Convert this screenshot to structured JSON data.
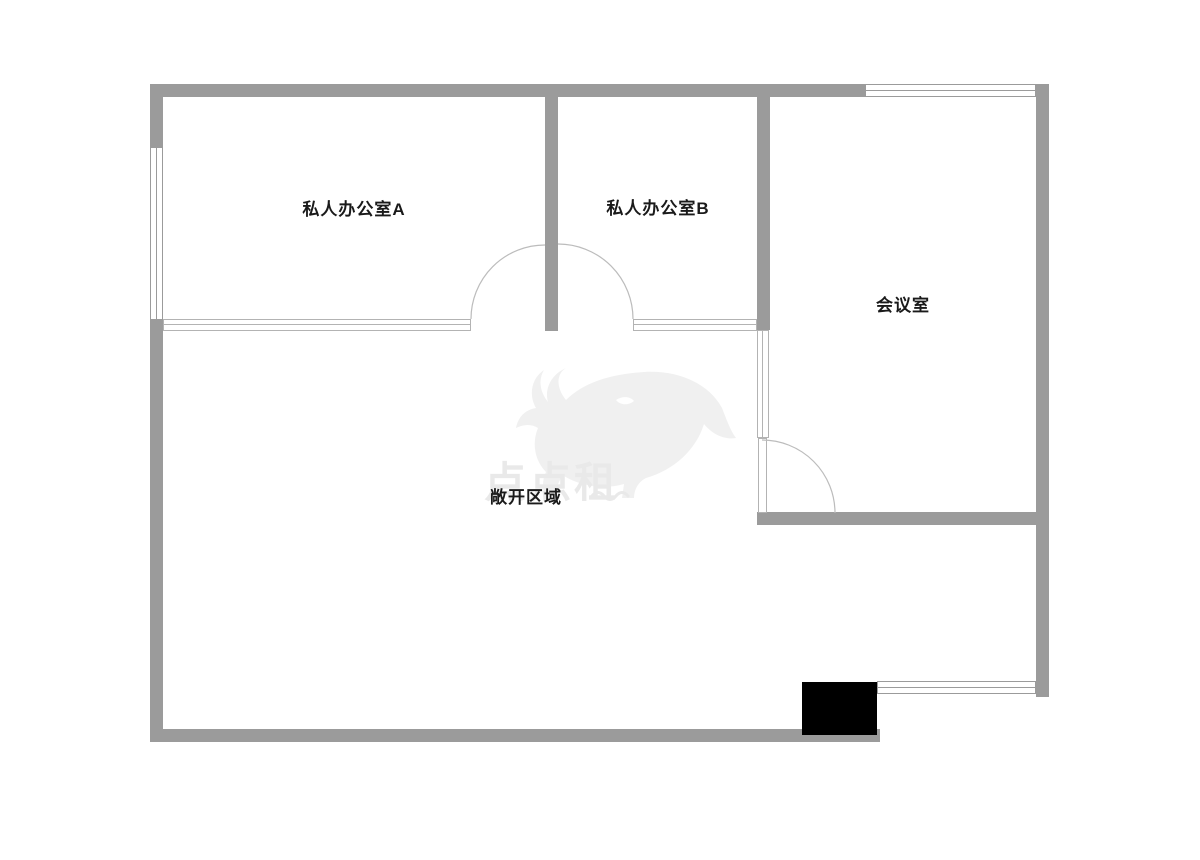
{
  "colors": {
    "background": "#ffffff",
    "wall": "#9b9b9b",
    "glass_line": "#b3b3b3",
    "window_line": "#9b9b9b",
    "arc": "#bcbcbc",
    "column": "#000000",
    "label": "#1a1a1a",
    "watermark": "#f0f0f0",
    "watermark_text": "#e9e9e9"
  },
  "rooms": {
    "private_office_a": {
      "label": "私人办公室A"
    },
    "private_office_b": {
      "label": "私人办公室B"
    },
    "meeting_room": {
      "label": "会议室"
    },
    "open_area": {
      "label": "敞开区域"
    }
  },
  "watermark": {
    "text": "点点租",
    "logo": "rhino-logo"
  }
}
